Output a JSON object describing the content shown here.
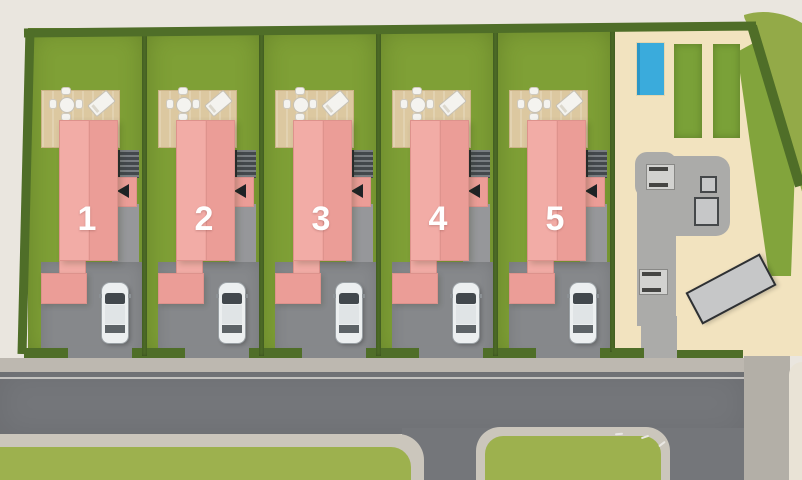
{
  "scene": {
    "plots": [
      {
        "number": "1"
      },
      {
        "number": "2"
      },
      {
        "number": "3"
      },
      {
        "number": "4"
      },
      {
        "number": "5"
      }
    ],
    "plot_count": 5,
    "cars_per_plot": 1
  },
  "icons": {
    "entrance-arrow": "left-pointing-triangle",
    "dining-table": "round-table-with-4-chairs",
    "sun-lounger": "lounger-pad",
    "parked-car": "car-top-view",
    "stairs": "step-lines",
    "swimming-pool": "blue-rectangle",
    "planting-bed": "green-rectangle",
    "outbuilding": "angled-grey-rectangle"
  },
  "palette": {
    "bg": "#eae6df",
    "bg2": "#e9e3d6",
    "field": "#93aa48",
    "lawn": "#7fa036",
    "lawn2": "#9db14e",
    "hedge": "#4f6e28",
    "sand": "#f2e3bf",
    "deck": "#dcc8a0",
    "deckline": "#cbb488",
    "roofL": "#f2aca6",
    "roofR": "#eb9d97",
    "roofEdge": "#dd928c",
    "patio": "#96979a",
    "drive": "#86888b",
    "road": "#74767a",
    "roadline": "#d8d6d2",
    "curb": "#bdb8b0",
    "walk": "#cbc6bc",
    "band": "#b3afa7",
    "pool": "#3aabdc",
    "poolEdge": "#2b96c6",
    "bed": "#7aa138",
    "bed2": "#82a43c",
    "path": "#ababa9",
    "loungerPad": "#d2d2d0",
    "metal": "#c6c7c8",
    "metalEdge": "#45484a",
    "white": "#f4f3ef",
    "dark": "#1f2326",
    "stairL": "#787d81",
    "stairD": "#43484c",
    "carbody": "#eceff0",
    "carline": "#9aa0a4",
    "glass": "#42484d",
    "flare": "#d8cfba"
  }
}
